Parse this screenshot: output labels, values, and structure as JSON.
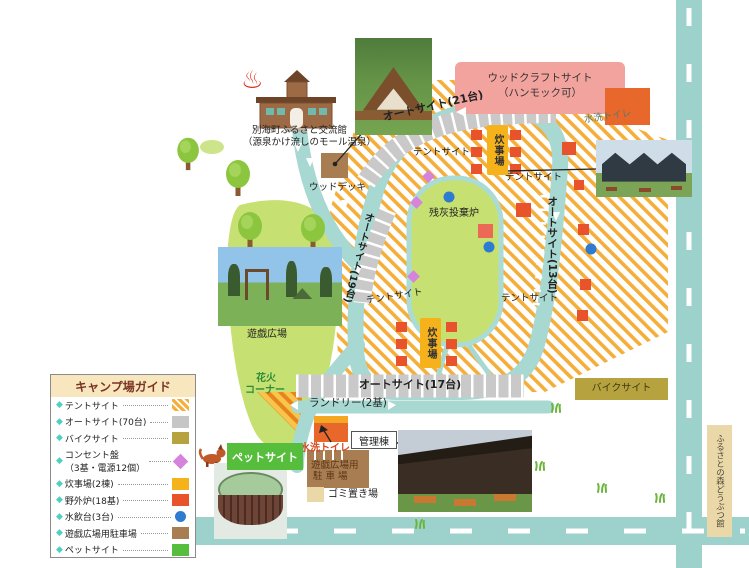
{
  "labels": {
    "hall_line1": "別海町ふるさと交流館",
    "hall_line2": "（源泉かけ流しのモール温泉）",
    "wood_deck": "ウッドデッキ",
    "woodcraft_line1": "ウッドクラフトサイト",
    "woodcraft_line2": "（ハンモック可）",
    "autosite_21": "オートサイト(21台)",
    "autosite_13": "オートサイト(13台)",
    "autosite_19": "オートサイト(19台)",
    "autosite_17": "オートサイト(17台)",
    "toilet": "水洗トイレ",
    "tent_site": "テントサイト",
    "cooking": "炊事場",
    "ash_furnace": "残灰投棄炉",
    "play_plaza": "遊戯広場",
    "fireworks_line1": "花火",
    "fireworks_line2": "コーナー",
    "laundry": "ランドリー(2基)",
    "admin_building": "管理棟",
    "plaza_parking_line1": "遊戯広場用",
    "plaza_parking_line2": "駐 車 場",
    "garbage": "ゴミ置き場",
    "bike_site": "バイクサイト",
    "pet_site": "ペットサイト",
    "animal_hall": "ふるさとの森どうぶつ館"
  },
  "legend": {
    "title": "キャンプ場ガイド",
    "bullet": "◆",
    "items": [
      {
        "label": "テントサイト",
        "swatch": "hatch"
      },
      {
        "label": "オートサイト(70台)",
        "swatch": "gray"
      },
      {
        "label": "バイクサイト",
        "swatch": "olive"
      },
      {
        "label": "コンセント盤",
        "label2": "（3基・電源12個）",
        "swatch": "diamond"
      },
      {
        "label": "炊事場(2棟)",
        "swatch": "yellow"
      },
      {
        "label": "野外炉(18基)",
        "swatch": "red"
      },
      {
        "label": "水飲台(3台)",
        "swatch": "blue"
      },
      {
        "label": "遊戯広場用駐車場",
        "swatch": "brown"
      },
      {
        "label": "ペットサイト",
        "swatch": "green"
      }
    ]
  },
  "icons": {
    "hot_spring": "♨"
  },
  "colors": {
    "tent_stripe": "#f4ae39",
    "road": "#a8d8d2",
    "green_area": "#c6e171",
    "woodcraft_pink": "#f2a39e",
    "parking_gray": "#c9c9c9",
    "bike_olive": "#b6a33f",
    "cooking_yellow": "#f6b21b",
    "furnace_red": "#e8532c",
    "water_blue": "#2f7bd0",
    "outlet_pink": "#d583db",
    "plaza_parking_brown": "#a87d52",
    "tan": "#ebd8a8",
    "pet_green": "#56be3c"
  }
}
